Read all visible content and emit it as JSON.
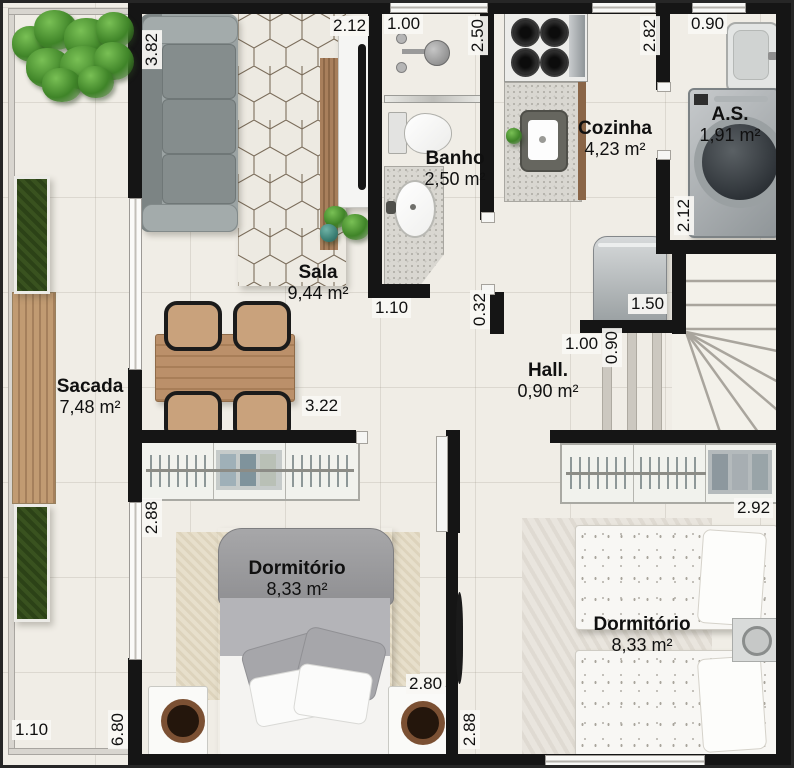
{
  "rooms": {
    "sala": {
      "name": "Sala",
      "area": "9,44 m²"
    },
    "banho": {
      "name": "Banho",
      "area": "2,50 m²"
    },
    "cozinha": {
      "name": "Cozinha",
      "area": "4,23 m²"
    },
    "area_servico": {
      "name": "A.S.",
      "area": "1,91 m²"
    },
    "hall": {
      "name": "Hall.",
      "area": "0,90 m²"
    },
    "sacada": {
      "name": "Sacada",
      "area": "7,48 m²"
    },
    "dormitorio1": {
      "name": "Dormitório",
      "area": "8,33 m²"
    },
    "dormitorio2": {
      "name": "Dormitório",
      "area": "8,33 m²"
    }
  },
  "dimensions": {
    "sala_height": "3.82",
    "sala_top_width": "2.12",
    "banho_width": "1.00",
    "banho_height": "2.50",
    "cozinha_height": "2.82",
    "as_width": "0.90",
    "as_height": "2.12",
    "cozinha_width": "1.50",
    "banho_bottom": "1.10",
    "wall_stub": "0.32",
    "hall_width": "1.00",
    "hall_depth": "0.90",
    "sala_bottom_width": "3.22",
    "dorm1_window": "2.88",
    "dorm2_width": "2.92",
    "dorm1_bottom": "2.80",
    "dorm2_height": "2.88",
    "sacada_height": "6.80",
    "sacada_width": "1.10"
  },
  "colors": {
    "wall": "#151515",
    "floor": "#f0ede6",
    "wood": "#b68b63",
    "sofa": "#8f9797",
    "plant": "#3f8428"
  }
}
